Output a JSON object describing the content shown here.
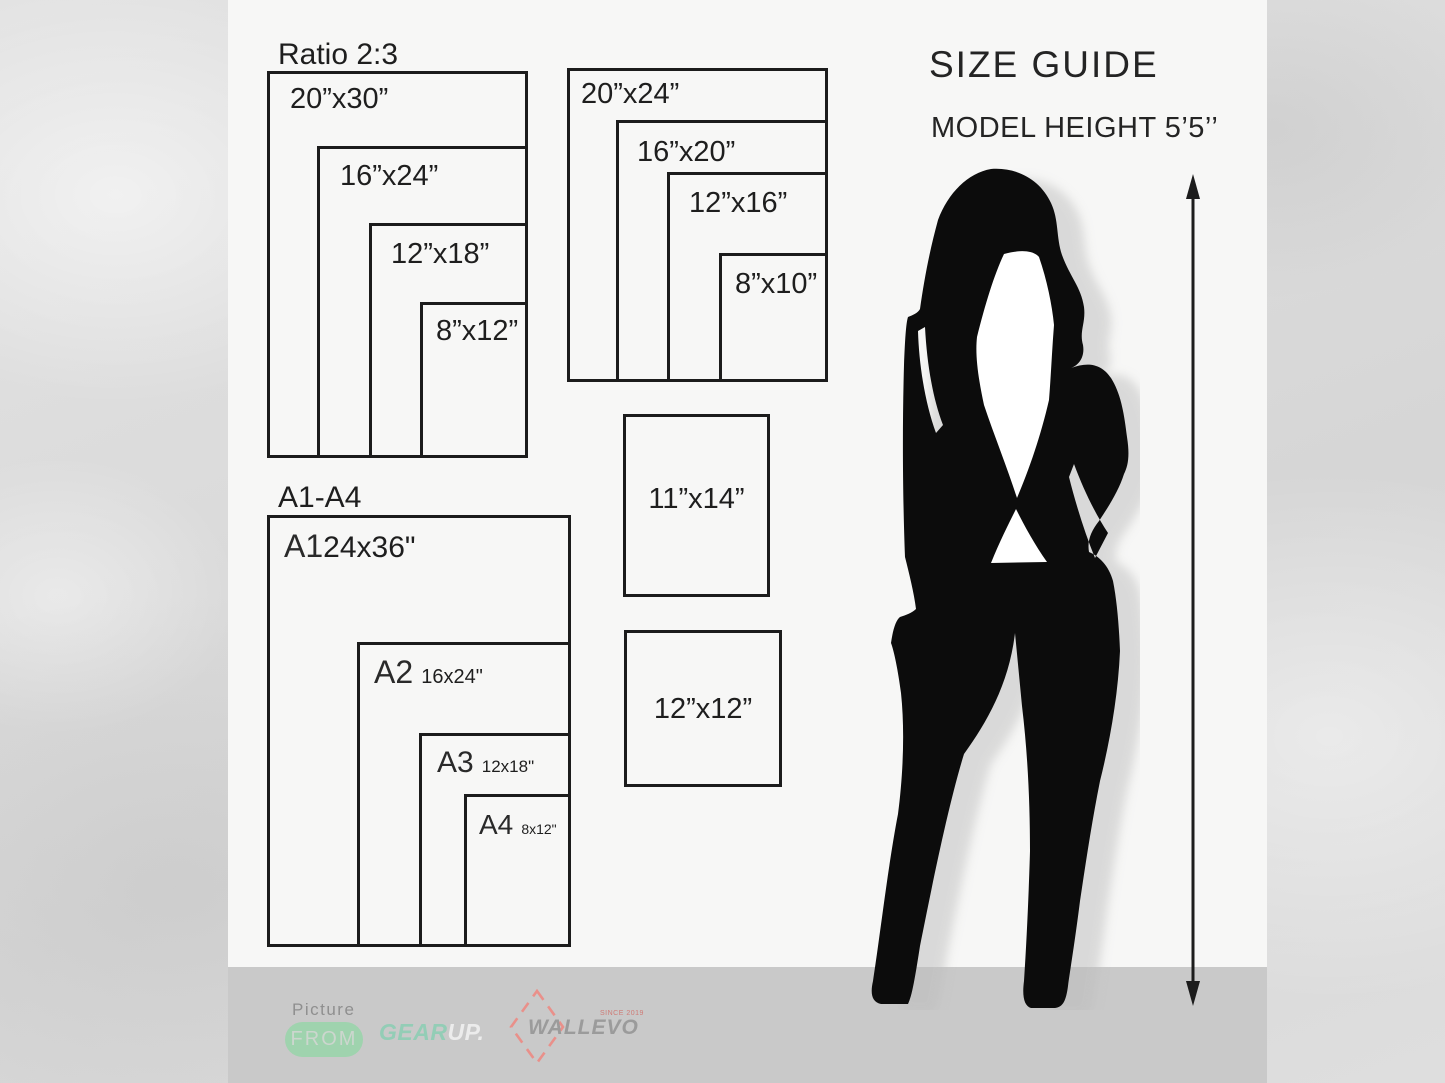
{
  "header": {
    "size_guide": "SIZE GUIDE",
    "model_height": "MODEL HEIGHT 5’5’’"
  },
  "ratio23": {
    "label": "Ratio 2:3",
    "sizes": [
      "20”x30”",
      "16”x24”",
      "12”x18”",
      "8”x12”"
    ]
  },
  "ratio45": {
    "sizes": [
      "20”x24”",
      "16”x20”",
      "12”x16”",
      "8”x10”"
    ]
  },
  "singles": {
    "s1114": "11”x14”",
    "s1212": "12”x12”"
  },
  "a_series": {
    "label": "A1-A4",
    "items": [
      {
        "name": "A1",
        "size": "24x36\""
      },
      {
        "name": "A2",
        "size": "16x24\""
      },
      {
        "name": "A3",
        "size": "12x18\""
      },
      {
        "name": "A4",
        "size": "8x12\""
      }
    ]
  },
  "footer": {
    "picture": "Picture",
    "from": "FROM",
    "gear": "GEAR",
    "up": "UP.",
    "brand": "WALLEVO",
    "since": "SINCE 2019"
  },
  "colors": {
    "accent_green": "#9fd3ae",
    "gear_mint": "#93cdb6",
    "brand_red": "#e9908a",
    "brand_gray": "#9b9b9b",
    "line": "#1c1c1c",
    "panel": "#f7f7f6",
    "footer_bar": "#c9c9c9"
  }
}
